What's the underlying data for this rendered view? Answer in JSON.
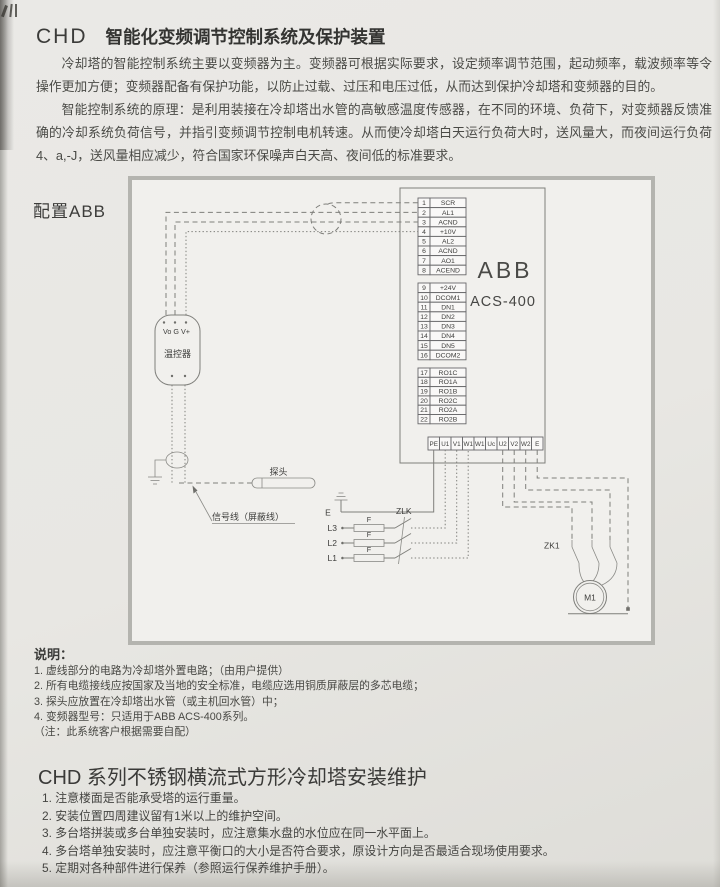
{
  "header": {
    "code": "CHD",
    "title": "智能化变频调节控制系统及保护装置"
  },
  "intro": {
    "p1": "冷却塔的智能控制系统主要以变频器为主。变频器可根据实际要求，设定频率调节范围，起动频率，载波频率等令操作更加方便；变频器配备有保护功能，以防止过载、过压和电压过低，从而达到保护冷却塔和变频器的目的。",
    "p2": "智能控制系统的原理：是利用装接在冷却塔出水管的高敏感温度传感器，在不同的环境、负荷下，对变频器反馈准确的冷却系统负荷信号，并指引变频调节控制电机转速。从而使冷却塔白天运行负荷大时，送风量大，而夜间运行负荷4、a,-J，送风量相应减少，符合国家环保噪声白天高、夜间低的标准要求。"
  },
  "diagram": {
    "caption": "配置ABB",
    "brand": "ABB",
    "model": "ACS-400",
    "terminals": {
      "analog": [
        [
          "1",
          "SCR"
        ],
        [
          "2",
          "AL1"
        ],
        [
          "3",
          "ACND"
        ],
        [
          "4",
          "+10V"
        ],
        [
          "5",
          "AL2"
        ],
        [
          "6",
          "ACND"
        ],
        [
          "7",
          "AO1"
        ],
        [
          "8",
          "ACEND"
        ]
      ],
      "digital": [
        [
          "9",
          "+24V"
        ],
        [
          "10",
          "DCOM1"
        ],
        [
          "11",
          "DN1"
        ],
        [
          "12",
          "DN2"
        ],
        [
          "13",
          "DN3"
        ],
        [
          "14",
          "DN4"
        ],
        [
          "15",
          "DN5"
        ],
        [
          "16",
          "DCOM2"
        ]
      ],
      "relay": [
        [
          "17",
          "RO1C"
        ],
        [
          "18",
          "RO1A"
        ],
        [
          "19",
          "RO1B"
        ],
        [
          "20",
          "RO2C"
        ],
        [
          "21",
          "RO2A"
        ],
        [
          "22",
          "RO2B"
        ]
      ],
      "power": [
        "PE",
        "U1",
        "V1",
        "W1",
        "W1",
        "Uc",
        "U2",
        "V2",
        "W2",
        "E"
      ]
    },
    "labels": {
      "thermostat": "温控器",
      "thermostat_pins": "Vo G V+",
      "probe": "探头",
      "signal_line": "信号线（屏蔽线）",
      "earth": "E",
      "l3": "L3",
      "l2": "L2",
      "l1": "L1",
      "fuse": "F",
      "breaker": "ZLK",
      "contactor": "ZK1",
      "motor": "M1"
    }
  },
  "notes": {
    "heading": "说明：",
    "items": [
      "1. 虚线部分的电路为冷却塔外置电路；（由用户提供）",
      "2. 所有电缆接线应按国家及当地的安全标准，电缆应选用铜质屏蔽层的多芯电缆；",
      "3. 探头应放置在冷却塔出水管（或主机回水管）中；",
      "4. 变频器型号：只适用于ABB ACS-400系列。"
    ],
    "footnote": "（注：此系统客户根据需要自配）"
  },
  "section2": {
    "title": "CHD 系列不锈钢横流式方形冷却塔安装维护",
    "items": [
      "1. 注意楼面是否能承受塔的运行重量。",
      "2. 安装位置四周建议留有1米以上的维护空间。",
      "3. 多台塔拼装或多台单独安装时，应注意集水盘的水位应在同一水平面上。",
      "4. 多台塔单独安装时，应注意平衡口的大小是否符合要求，原设计方向是否最适合现场使用要求。",
      "5. 定期对各种部件进行保养（参照运行保养维护手册）。"
    ]
  }
}
